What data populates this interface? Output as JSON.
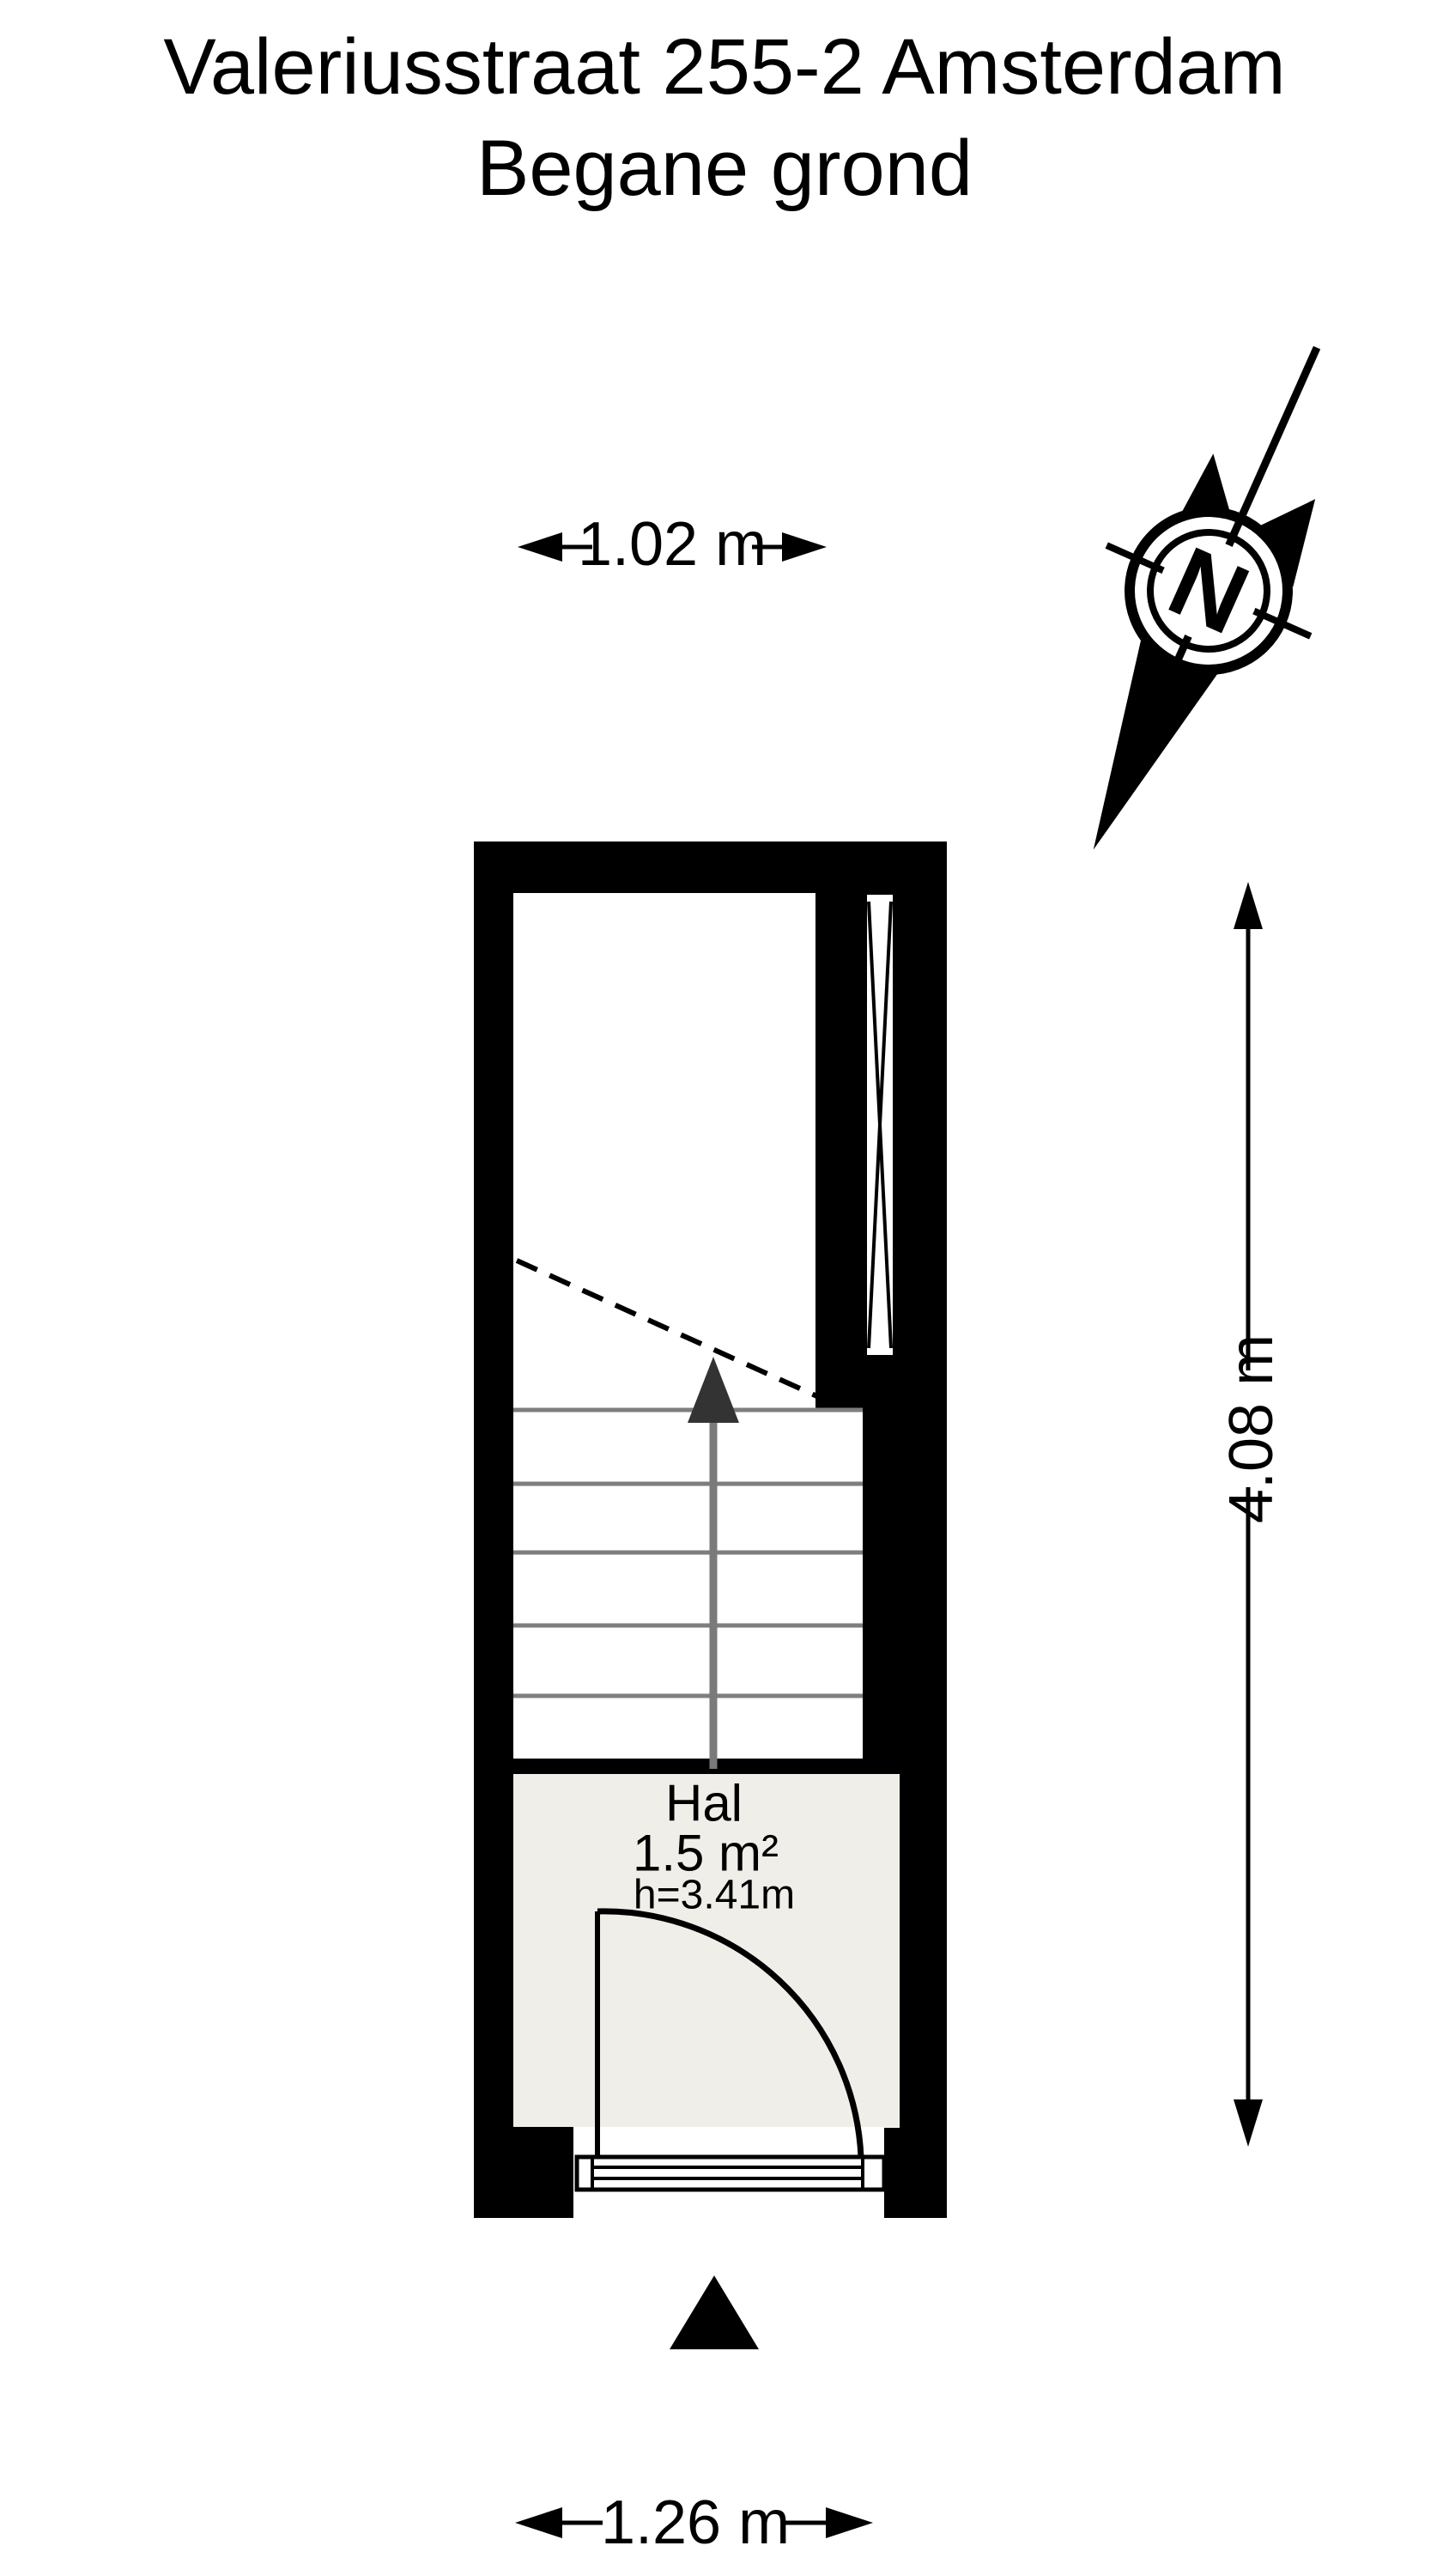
{
  "header": {
    "title": "Valeriusstraat 255-2 Amsterdam",
    "subtitle": "Begane grond"
  },
  "compass": {
    "letter": "N"
  },
  "dimensions": {
    "top_width": "1.02 m",
    "right_height": "4.08 m",
    "bottom_width": "1.26 m"
  },
  "room": {
    "name": "Hal",
    "area": "1.5 m²",
    "ceiling_height": "h=3.41m"
  },
  "colors": {
    "background": "#ffffff",
    "wall": "#000000",
    "hal_floor": "#efeee8",
    "stair_tread_line": "#7e7e7e",
    "stair_arrow_line": "#7a7a7a",
    "stair_arrow_head": "#333333"
  }
}
